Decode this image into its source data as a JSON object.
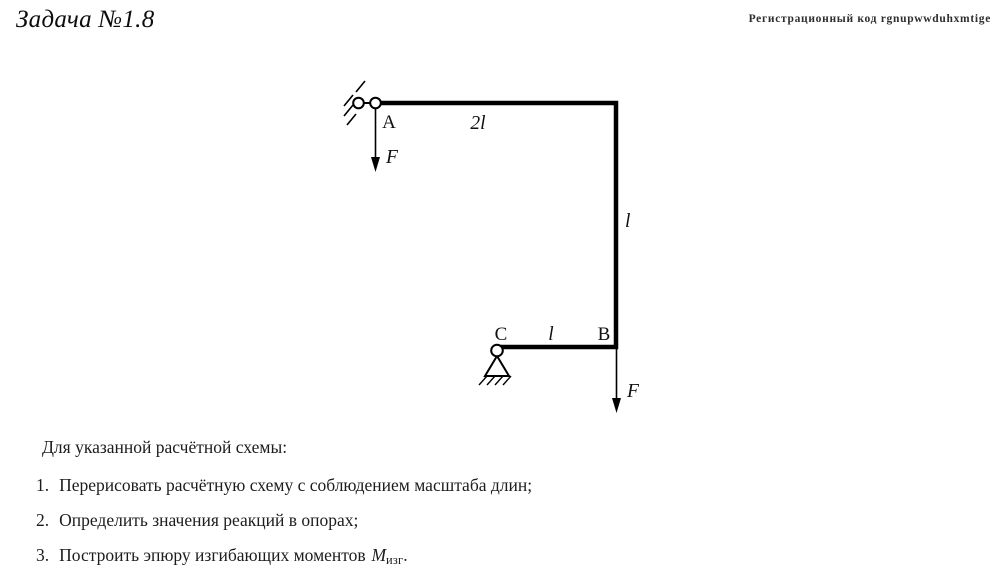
{
  "header": {
    "title": "Задача №1.8",
    "registration": "Регистрационный код rgnupwwduhxmtige"
  },
  "diagram": {
    "node_a": "A",
    "node_b": "B",
    "node_c": "C",
    "span_top": "2l",
    "span_right": "l",
    "span_bottom": "l",
    "force_top": "F",
    "force_bottom": "F"
  },
  "task": {
    "intro": "Для указанной расчётной схемы:",
    "items": [
      {
        "num": "1.",
        "text": "Перерисовать расчётную схему с соблюдением масштаба длин;"
      },
      {
        "num": "2.",
        "text": "Определить значения реакций в опорах;"
      },
      {
        "num": "3.",
        "text": "Построить эпюру изгибающих моментов"
      }
    ],
    "moment": {
      "base": "M",
      "sub": "изг",
      "period": "."
    }
  },
  "colors": {
    "ink": "#000000",
    "text": "#1c1c1c",
    "muted": "#2e2e2e"
  }
}
